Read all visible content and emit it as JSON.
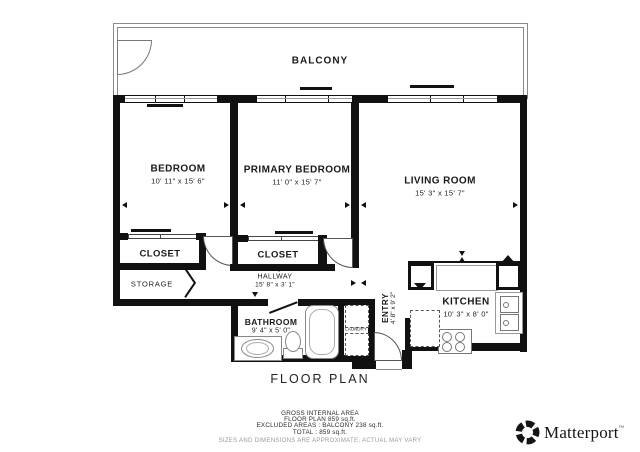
{
  "plan": {
    "balcony": "BALCONY",
    "rooms": [
      {
        "name": "BEDROOM",
        "dims": "10' 11\" x 15' 6\""
      },
      {
        "name": "PRIMARY BEDROOM",
        "dims": "11' 0\" x 15' 7\""
      },
      {
        "name": "LIVING ROOM",
        "dims": "15' 3\" x 15' 7\""
      },
      {
        "name": "HALLWAY",
        "dims": "15' 8\" x 3' 1\""
      },
      {
        "name": "BATHROOM",
        "dims": "9' 4\" x 5' 0\""
      },
      {
        "name": "ENTRY",
        "dims": "4' 8\" x 9' 2\""
      },
      {
        "name": "KITCHEN",
        "dims": "10' 3\" x 8' 0\""
      }
    ],
    "closet_label": "CLOSET",
    "storage_label": "STORAGE",
    "laundry_label": "LAUNDRY"
  },
  "title": "FLOOR PLAN",
  "footer": {
    "area_heading": "GROSS INTERNAL AREA",
    "floor_plan_area": "FLOOR PLAN 859 sq.ft.",
    "excluded": "EXCLUDED AREAS :  BALCONY 238 sq.ft.",
    "total": "TOTAL :  859 sq.ft.",
    "disclaimer": "SIZES AND DIMENSIONS ARE APPROXIMATE, ACTUAL MAY VARY"
  },
  "branding": {
    "name": "Matterport",
    "trademark": "™"
  },
  "colors": {
    "wall": "#111111",
    "balcony_wall": "#8a8a8a",
    "fixture_line": "#888888",
    "text": "#1a1a1a"
  }
}
